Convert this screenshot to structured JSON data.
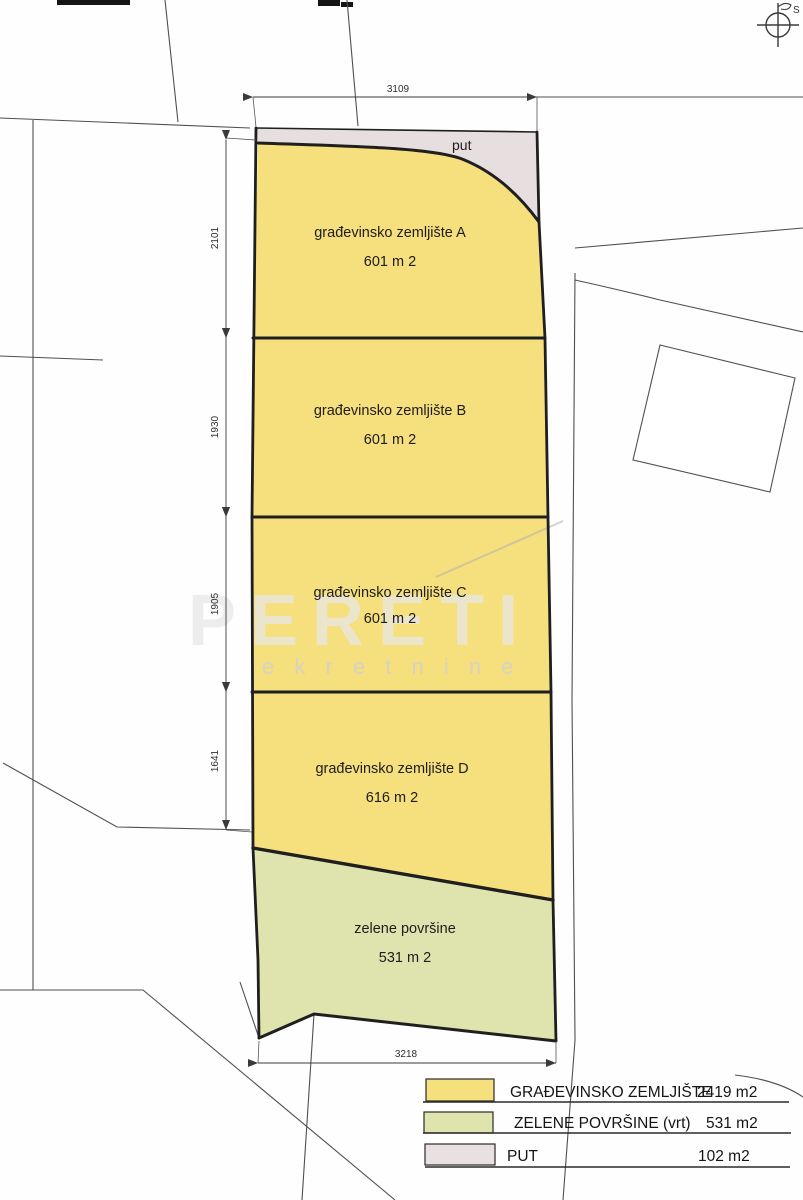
{
  "colors": {
    "building_land": "#f6df7d",
    "green_area": "#dfe4ae",
    "road": "#e7dfdf",
    "outline": "#1f1f1f",
    "thin_line": "#4f4f4f"
  },
  "compass": {
    "north_label": "S"
  },
  "dimensions": {
    "top_width": "3109",
    "bottom_width": "3218",
    "left_segments": [
      "2101",
      "1930",
      "1905",
      "1641"
    ]
  },
  "parcels": {
    "put": {
      "label": "put"
    },
    "a": {
      "name": "građevinsko zemljište A",
      "area": "601 m 2"
    },
    "b": {
      "name": "građevinsko zemljište B",
      "area": "601 m 2"
    },
    "c": {
      "name": "građevinsko zemljište C",
      "area": "601 m 2"
    },
    "d": {
      "name": "građevinsko zemljište D",
      "area": "616 m 2"
    },
    "green": {
      "name": "zelene površine",
      "area": "531 m 2"
    }
  },
  "legend": {
    "rows": [
      {
        "label": "GRAĐEVINSKO ZEMLJIŠTE",
        "value": "2419 m2",
        "color": "#f6df7d"
      },
      {
        "label": "ZELENE POVRŠINE (vrt)",
        "value": "531 m2",
        "color": "#dfe4ae"
      },
      {
        "label": "PUT",
        "value": "102 m2",
        "color": "#e9e1e1"
      }
    ]
  },
  "watermark": {
    "line1": "PERETI",
    "line2": "e k r e t n i n e"
  }
}
